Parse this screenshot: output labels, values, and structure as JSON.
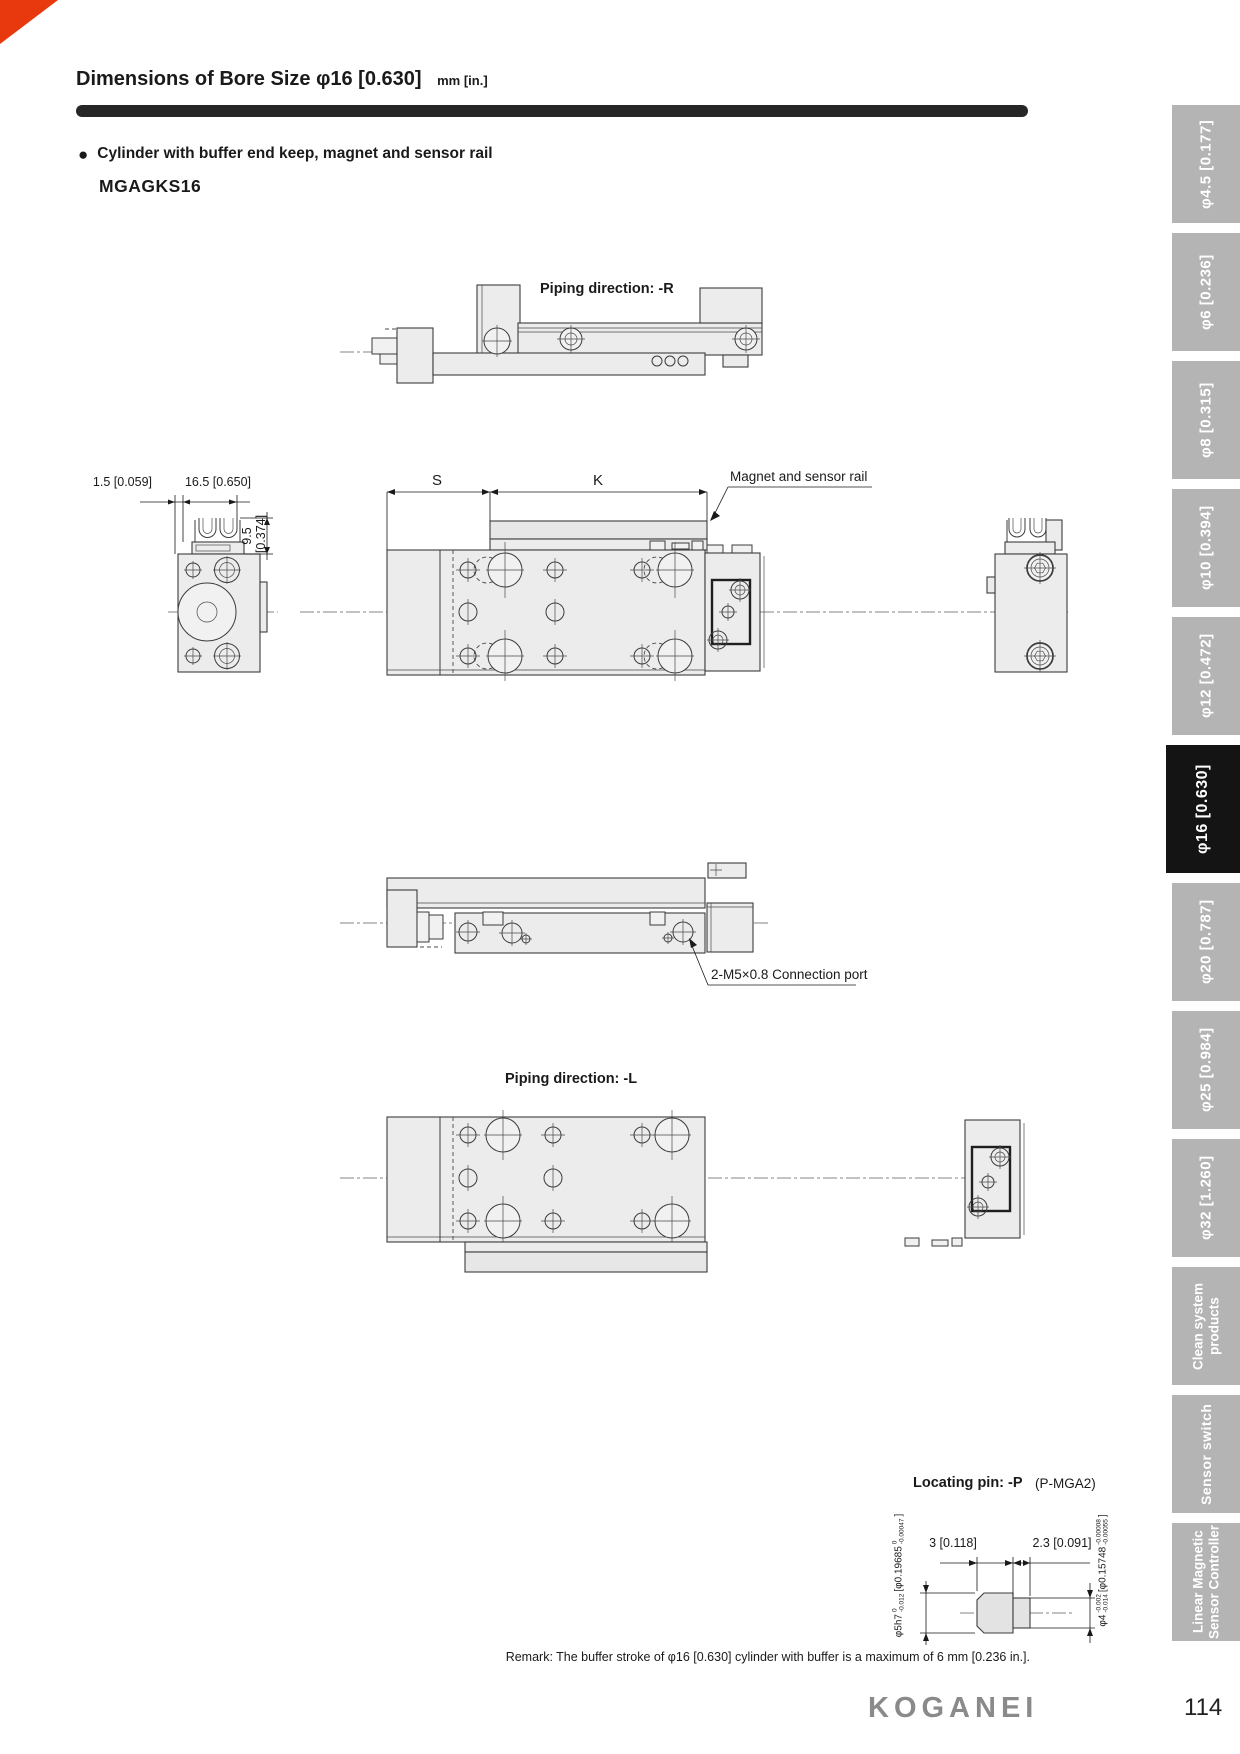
{
  "page": {
    "title": "Dimensions of Bore Size",
    "title_bore": "φ16 [0.630]",
    "title_units": "mm [in.]",
    "bullet": "●",
    "section_heading": "Cylinder with buffer end keep, magnet and sensor rail",
    "model": "MGAGKS16",
    "remark": "Remark: The buffer stroke of φ16 [0.630] cylinder with buffer is a maximum of 6 mm [0.236 in.].",
    "brand": "KOGANEI",
    "page_number": "114"
  },
  "colors": {
    "accent_red": "#e8380d",
    "tab_gray": "#b4b4b4",
    "tab_active": "#141414",
    "bar_black": "#262626"
  },
  "figures": {
    "piping_r": "Piping direction: -R",
    "piping_l": "Piping direction: -L",
    "magnet_rail": "Magnet and sensor rail",
    "connection_port": "2-M5×0.8 Connection port",
    "dims": {
      "d15": "1.5 [0.059]",
      "d165": "16.5 [0.650]",
      "d95": "9.5",
      "d95in": "[0.374]",
      "s": "S",
      "k": "K"
    }
  },
  "locating_pin": {
    "heading": "Locating pin: -P",
    "heading_note": "(P-MGA2)",
    "dim_len1": "3 [0.118]",
    "dim_len2": "2.3 [0.091]",
    "dia_left": {
      "main": "φ5h7",
      "tol_top": "0",
      "tol_bot": "-0.012",
      "bracket": "[φ0.19685",
      "tol2_top": "0",
      "tol2_bot": "-0.00047",
      "close": "]"
    },
    "dia_right": {
      "main": "φ4",
      "tol_top": "-0.002",
      "tol_bot": "-0.014",
      "bracket": "[φ0.15748",
      "tol2_top": "-0.00008",
      "tol2_bot": "-0.00055",
      "close": "]"
    }
  },
  "sidebar": {
    "tabs": [
      {
        "label": "φ4.5 [0.177]",
        "active": false
      },
      {
        "label": "φ6 [0.236]",
        "active": false
      },
      {
        "label": "φ8 [0.315]",
        "active": false
      },
      {
        "label": "φ10 [0.394]",
        "active": false
      },
      {
        "label": "φ12 [0.472]",
        "active": false
      },
      {
        "label": "φ16 [0.630]",
        "active": true
      },
      {
        "label": "φ20 [0.787]",
        "active": false
      },
      {
        "label": "φ25 [0.984]",
        "active": false
      },
      {
        "label": "φ32 [1.260]",
        "active": false
      },
      {
        "label": "Clean system",
        "label2": "products",
        "active": false
      },
      {
        "label": "Sensor switch",
        "active": false
      },
      {
        "label": "Linear Magnetic",
        "label2": "Sensor Controller",
        "active": false
      }
    ]
  }
}
